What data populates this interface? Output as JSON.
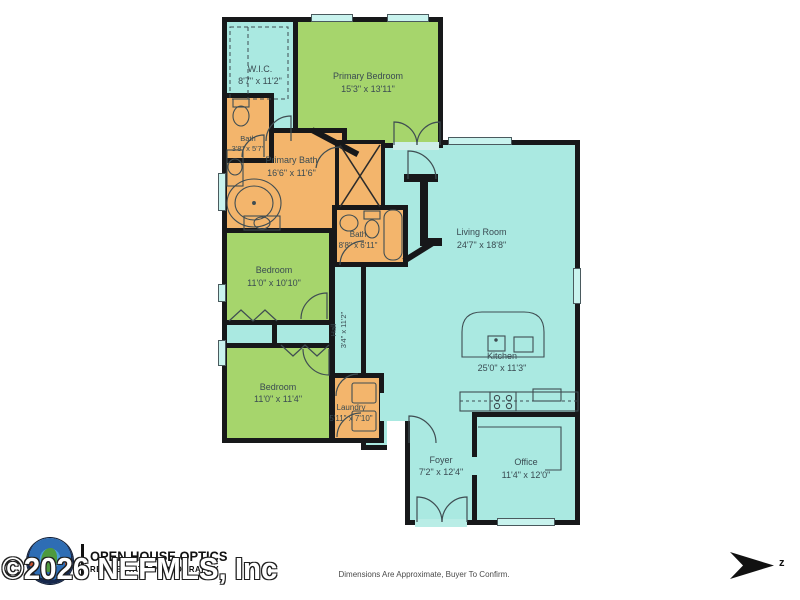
{
  "plan": {
    "rooms": [
      {
        "id": "wic",
        "label": "W.I.C.",
        "dims": "8'7\" x 11'2\""
      },
      {
        "id": "primary_bedroom",
        "label": "Primary Bedroom",
        "dims": "15'3\" x 13'11\""
      },
      {
        "id": "bath_small",
        "label": "Bath",
        "dims": "3'8\" x 5'7\""
      },
      {
        "id": "primary_bath",
        "label": "Primary Bath",
        "dims": "16'6\" x 11'6\""
      },
      {
        "id": "bath",
        "label": "Bath",
        "dims": "8'8\" x 6'11\""
      },
      {
        "id": "living_room",
        "label": "Living Room",
        "dims": "24'7\" x 18'8\""
      },
      {
        "id": "bedroom_1",
        "label": "Bedroom",
        "dims": "11'0\" x 10'10\""
      },
      {
        "id": "hall",
        "label": "Hall",
        "dims": "3'4\" x 11'2\""
      },
      {
        "id": "kitchen",
        "label": "Kitchen",
        "dims": "25'0\" x 11'3\""
      },
      {
        "id": "bedroom_2",
        "label": "Bedroom",
        "dims": "11'0\" x 11'4\""
      },
      {
        "id": "laundry",
        "label": "Laundry",
        "dims": "5'11\" x 7'10\""
      },
      {
        "id": "foyer",
        "label": "Foyer",
        "dims": "7'2\" x 12'4\""
      },
      {
        "id": "office",
        "label": "Office",
        "dims": "11'4\" x 12'0\""
      }
    ],
    "colors": {
      "room_teal": "#aae9e1",
      "room_green": "#a6d56c",
      "room_orange": "#f3b56c",
      "wall": "#17181a"
    }
  },
  "footer": {
    "logo_line1": "OPEN HOUSE OPTICS",
    "logo_line2": "REAL ESTATE PHOTOGRAPHY",
    "watermark": "©2026 NEFMLS, Inc",
    "disclaimer": "Dimensions Are Approximate, Buyer To Confirm.",
    "compass_label": "z"
  }
}
